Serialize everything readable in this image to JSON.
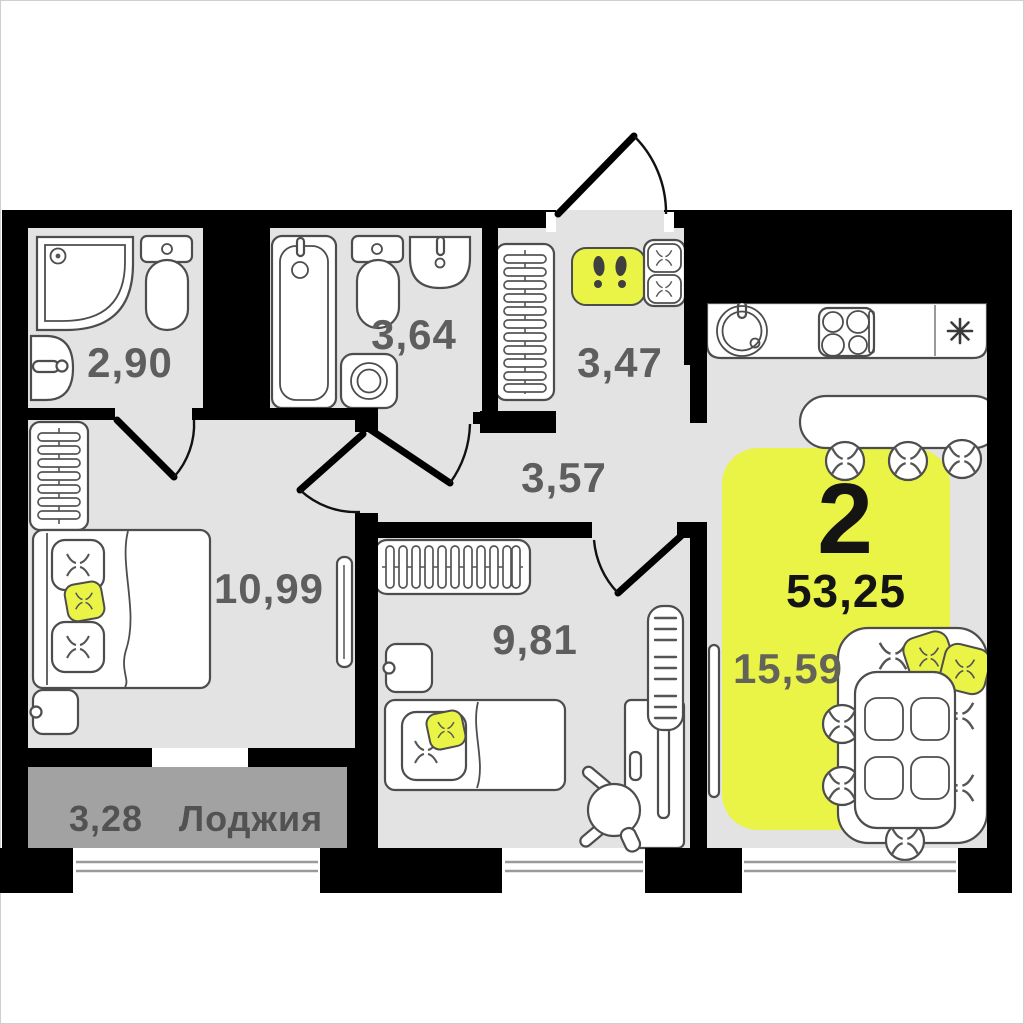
{
  "plan": {
    "card": {
      "rooms_count": "2",
      "total_area": "53,25"
    },
    "rooms": {
      "bathroom_small": {
        "area": "2,90"
      },
      "bathroom_large": {
        "area": "3,64"
      },
      "entry": {
        "area": "3,47"
      },
      "hallway": {
        "area": "3,57"
      },
      "bedroom": {
        "area": "10,99"
      },
      "child_room": {
        "area": "9,81"
      },
      "living_room": {
        "area": "15,59"
      },
      "loggia": {
        "area": "3,28",
        "name": "Лоджия"
      }
    },
    "icons": {
      "fridge": "asterisk-icon",
      "entry_mat": "footprints-icon"
    },
    "colors": {
      "accent": "#EAF447",
      "floor": "#E3E3E3",
      "loggia_floor": "#A2A2A2",
      "wall": "#000000",
      "label": "#5E5E5E"
    }
  }
}
